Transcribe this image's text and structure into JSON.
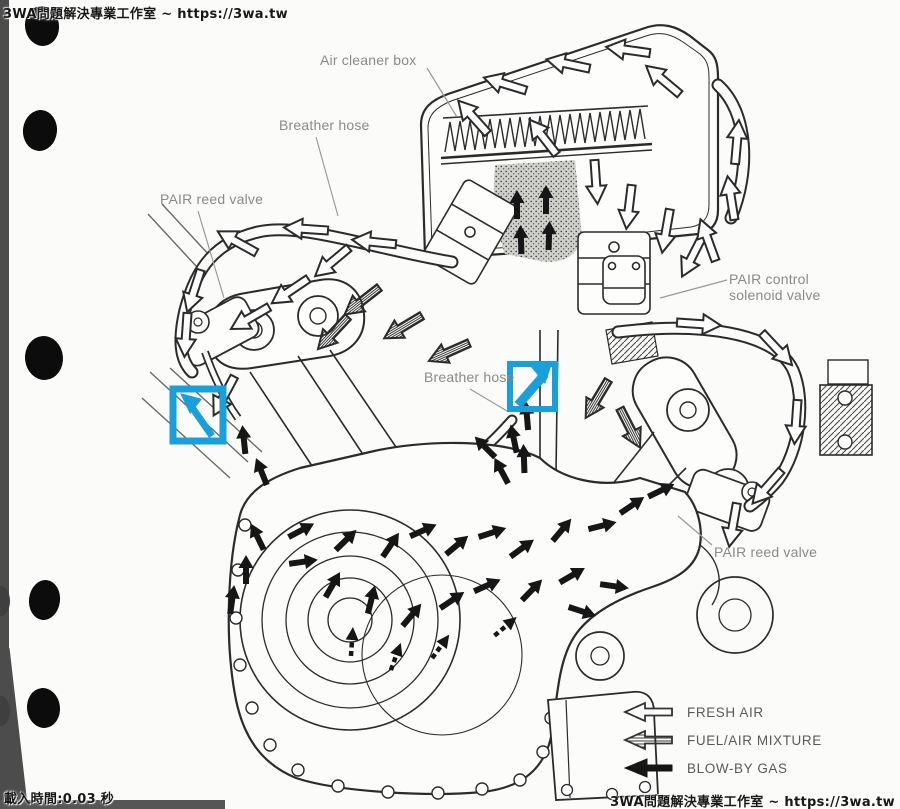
{
  "watermarks": {
    "top_left": "3WA問題解決專業工作室 ~ https://3wa.tw",
    "bottom_left": "載入時間:0.03 秒",
    "bottom_right": "3WA問題解決專業工作室 ~ https://3wa.tw"
  },
  "diagram": {
    "subject": "Engine PAIR / crankcase breather air-flow cross-section",
    "callouts": {
      "air_cleaner_box": "Air cleaner box",
      "breather_hose_top": "Breather hose",
      "pair_reed_valve_left": "PAIR reed valve",
      "pair_control_line1": "PAIR control",
      "pair_control_line2": "solenoid valve",
      "breather_hose_center": "Breather hose",
      "pair_reed_valve_right": "PAIR reed valve"
    },
    "legend": {
      "items": [
        {
          "id": "fresh-air",
          "label": "FRESH AIR",
          "arrow_style": "open-outline"
        },
        {
          "id": "fuel-air-mixture",
          "label": "FUEL/AIR MIXTURE",
          "arrow_style": "hatched"
        },
        {
          "id": "blow-by-gas",
          "label": "BLOW-BY GAS",
          "arrow_style": "solid-black"
        }
      ]
    },
    "highlight_markers": [
      {
        "id": "left",
        "shape": "square-outline",
        "arrow_direction": "up-left"
      },
      {
        "id": "right",
        "shape": "square-outline",
        "arrow_direction": "up-right"
      }
    ],
    "colors": {
      "highlight": "#199fd9",
      "line_art": "#2b2b2b",
      "label_text": "#8a8a8a",
      "legend_text": "#5a5a5a",
      "page_edge": "#4c4c4c"
    }
  }
}
